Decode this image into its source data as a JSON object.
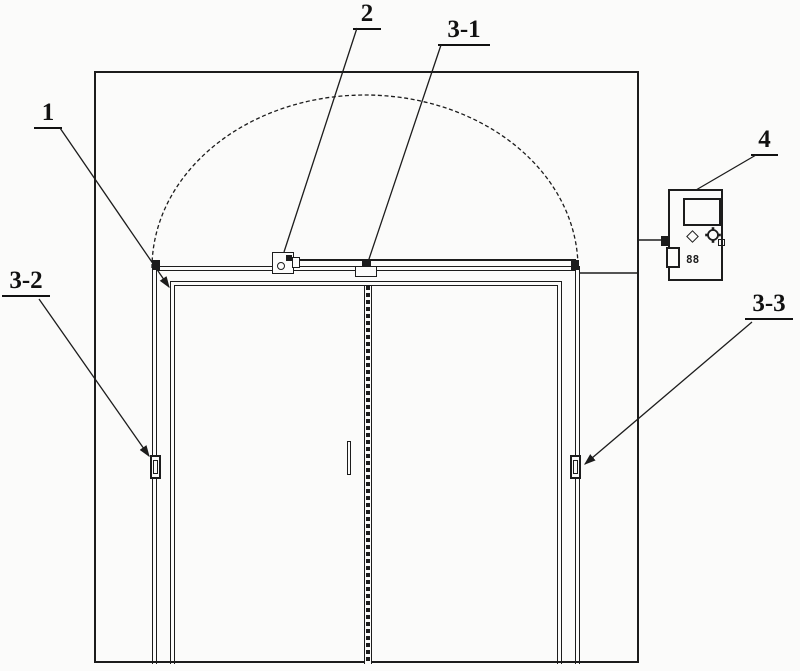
{
  "figure": {
    "kind": "patent-line-drawing",
    "subject": "arched automatic double sliding door with controller",
    "background_color": "#fbfbfa",
    "line_color": "#1c1c1c"
  },
  "callouts": {
    "header_track": {
      "text": "1"
    },
    "drive_unit": {
      "text": "2"
    },
    "belt_clamp": {
      "text": "3-1"
    },
    "left_guide_sensor": {
      "text": "3-2"
    },
    "right_guide_sensor": {
      "text": "3-3"
    },
    "controller": {
      "text": "4"
    }
  },
  "controller_panel": {
    "counter_text": "88",
    "icons": [
      "diamond-indicator-icon",
      "rotary-knob-icon",
      "display-screen"
    ]
  }
}
